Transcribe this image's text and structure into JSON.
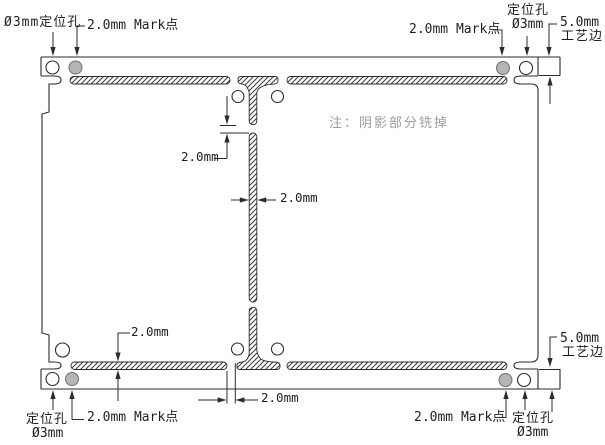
{
  "drawing": {
    "note": "注：阴影部分铣掉",
    "labels": {
      "top_left_hole": "Ø3mm定位孔",
      "top_left_mark": "2.0mm Mark点",
      "top_right_mark": "2.0mm Mark点",
      "top_right_hole_1": "定位孔",
      "top_right_hole_2": "Ø3mm",
      "top_right_edge_1": "5.0mm",
      "top_right_edge_2": "工艺边",
      "bottom_left_hole_1": "定位孔",
      "bottom_left_hole_2": "Ø3mm",
      "bottom_left_mark": "2.0mm Mark点",
      "bottom_right_mark": "2.0mm Mark点",
      "bottom_right_hole_1": "定位孔",
      "bottom_right_hole_2": "Ø3mm",
      "bottom_right_edge_1": "5.0mm",
      "bottom_right_edge_2": "工艺边"
    },
    "dimensions": {
      "center_tab_gap": "2.0mm",
      "slot_width": "2.0mm",
      "bottom_slot_width": "2.0mm",
      "bottom_tab_gap": "2.0mm"
    },
    "colors": {
      "line": "#2b2b2b",
      "hatch": "#3a3a3a",
      "mark_fill": "#b5b5b5",
      "note_text": "#9c9c9c",
      "background": "#ffffff"
    }
  }
}
